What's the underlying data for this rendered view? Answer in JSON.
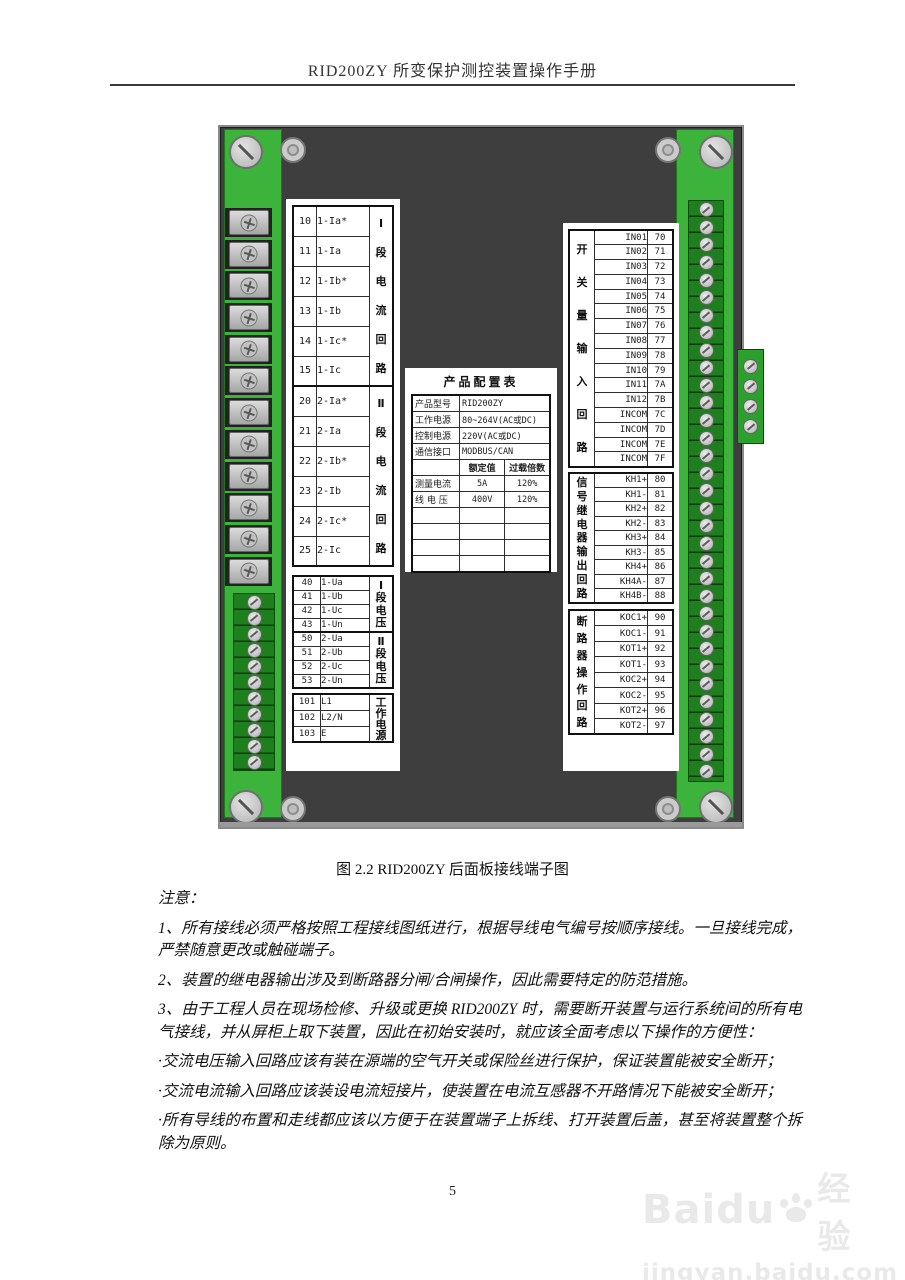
{
  "page": {
    "header_title": "RID200ZY 所变保护测控装置操作手册",
    "caption": "图 2.2 RID200ZY 后面板接线端子图",
    "page_number": "5"
  },
  "colors": {
    "panel_gray": "#3E3E3E",
    "strip_green": "#3CB43C",
    "terminal_green": "#1F7F1F",
    "screw_silver": "#c9c9c9"
  },
  "terminal_tables": {
    "current_sections": [
      {
        "group": "Ⅰ段电流回路",
        "rows": [
          [
            "10",
            "1-Ia*"
          ],
          [
            "11",
            "1-Ia"
          ],
          [
            "12",
            "1-Ib*"
          ],
          [
            "13",
            "1-Ib"
          ],
          [
            "14",
            "1-Ic*"
          ],
          [
            "15",
            "1-Ic"
          ]
        ]
      },
      {
        "group": "Ⅱ段电流回路",
        "rows": [
          [
            "20",
            "2-Ia*"
          ],
          [
            "21",
            "2-Ia"
          ],
          [
            "22",
            "2-Ib*"
          ],
          [
            "23",
            "2-Ib"
          ],
          [
            "24",
            "2-Ic*"
          ],
          [
            "25",
            "2-Ic"
          ]
        ]
      }
    ],
    "voltage_sections": [
      {
        "group": "Ⅰ段电压",
        "rows": [
          [
            "40",
            "1-Ua"
          ],
          [
            "41",
            "1-Ub"
          ],
          [
            "42",
            "1-Uc"
          ],
          [
            "43",
            "1-Un"
          ]
        ]
      },
      {
        "group": "Ⅱ段电压",
        "rows": [
          [
            "50",
            "2-Ua"
          ],
          [
            "51",
            "2-Ub"
          ],
          [
            "52",
            "2-Uc"
          ],
          [
            "53",
            "2-Un"
          ]
        ]
      }
    ],
    "power_sections": [
      {
        "group": "工作电源",
        "rows": [
          [
            "101",
            "L1"
          ],
          [
            "102",
            "L2/N"
          ],
          [
            "103",
            "E"
          ]
        ]
      }
    ],
    "input_sections": [
      {
        "group": "开关量输入回路",
        "rows": [
          [
            "IN01",
            "70"
          ],
          [
            "IN02",
            "71"
          ],
          [
            "IN03",
            "72"
          ],
          [
            "IN04",
            "73"
          ],
          [
            "IN05",
            "74"
          ],
          [
            "IN06",
            "75"
          ],
          [
            "IN07",
            "76"
          ],
          [
            "IN08",
            "77"
          ],
          [
            "IN09",
            "78"
          ],
          [
            "IN10",
            "79"
          ],
          [
            "IN11",
            "7A"
          ],
          [
            "IN12",
            "7B"
          ],
          [
            "INCOM",
            "7C"
          ],
          [
            "INCOM",
            "7D"
          ],
          [
            "INCOM",
            "7E"
          ],
          [
            "INCOM",
            "7F"
          ]
        ]
      }
    ],
    "relay_sections": [
      {
        "group": "信号继电器输出回路",
        "rows": [
          [
            "KH1+",
            "80"
          ],
          [
            "KH1-",
            "81"
          ],
          [
            "KH2+",
            "82"
          ],
          [
            "KH2-",
            "83"
          ],
          [
            "KH3+",
            "84"
          ],
          [
            "KH3-",
            "85"
          ],
          [
            "KH4+",
            "86"
          ],
          [
            "KH4A-",
            "87"
          ],
          [
            "KH4B-",
            "88"
          ]
        ]
      }
    ],
    "breaker_sections": [
      {
        "group": "断路器操作回路",
        "rows": [
          [
            "KOC1+",
            "90"
          ],
          [
            "KOC1-",
            "91"
          ],
          [
            "KOT1+",
            "92"
          ],
          [
            "KOT1-",
            "93"
          ],
          [
            "KOC2+",
            "94"
          ],
          [
            "KOC2-",
            "95"
          ],
          [
            "KOT2+",
            "96"
          ],
          [
            "KOT2-",
            "97"
          ]
        ]
      }
    ]
  },
  "config_table": {
    "title": "产品配置表",
    "info_rows": [
      [
        "产品型号",
        "RID200ZY"
      ],
      [
        "工作电源",
        "80~264V(AC或DC)"
      ],
      [
        "控制电源",
        "220V(AC或DC)"
      ],
      [
        "通信接口",
        "MODBUS/CAN"
      ]
    ],
    "header_row": [
      "",
      "额定值",
      "过载倍数"
    ],
    "data_rows": [
      [
        "测量电流",
        "5A",
        "120%"
      ],
      [
        "线 电 压",
        "400V",
        "120%"
      ]
    ],
    "empty_row_count": 4
  },
  "notes": {
    "label": "注意：",
    "items": [
      "1、所有接线必须严格按照工程接线图纸进行，根据导线电气编号按顺序接线。一旦接线完成，严禁随意更改或触碰端子。",
      "2、装置的继电器输出涉及到断路器分闸/合闸操作，因此需要特定的防范措施。",
      "3、由于工程人员在现场检修、升级或更换 RID200ZY 时，需要断开装置与运行系统间的所有电气接线，并从屏柜上取下装置，因此在初始安装时，就应该全面考虑以下操作的方便性："
    ],
    "bullets": [
      "·交流电压输入回路应该有装在源端的空气开关或保险丝进行保护，保证装置能被安全断开；",
      "·交流电流输入回路应该装设电流短接片，使装置在电流互感器不开路情况下能被安全断开；",
      "·所有导线的布置和走线都应该以方便于在装置端子上拆线、打开装置后盖，甚至将装置整个拆除为原则。"
    ]
  },
  "watermark": {
    "brand": "Baidu",
    "suffix": "经验",
    "url": "jingyan.baidu.com"
  }
}
